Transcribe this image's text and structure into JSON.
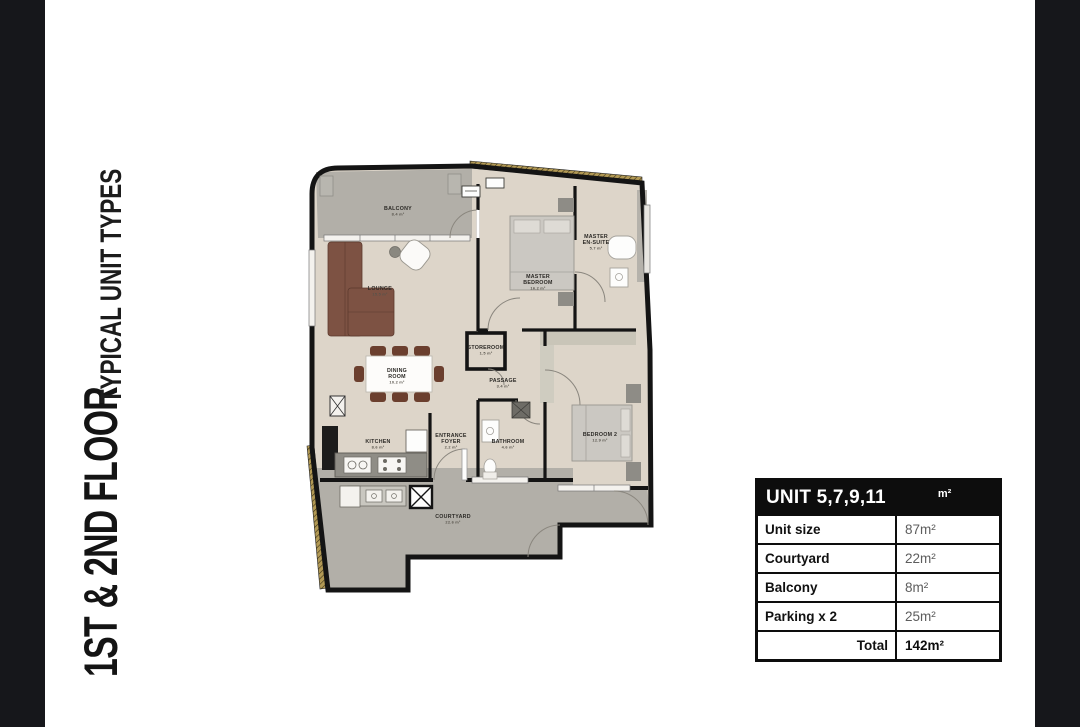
{
  "page": {
    "main_title": "1ST & 2ND FLOOR",
    "sub_title": "TYPICAL UNIT TYPES"
  },
  "unit_table": {
    "header": {
      "unit_name": "UNIT 5,7,9,11",
      "unit_sup": "m²"
    },
    "rows": [
      {
        "label": "Unit size",
        "value": "87m²"
      },
      {
        "label": "Courtyard",
        "value": "22m²"
      },
      {
        "label": "Balcony",
        "value": "8m²"
      },
      {
        "label": "Parking x 2",
        "value": "25m²"
      }
    ],
    "total": {
      "label": "Total",
      "value": "142m²"
    }
  },
  "floor_plan": {
    "rooms": [
      {
        "id": "balcony",
        "lines": [
          "BALCONY"
        ],
        "area": "8.4 m²",
        "x": 108,
        "y": 60
      },
      {
        "id": "lounge",
        "lines": [
          "LOUNGE"
        ],
        "area": "15.5 m²",
        "x": 90,
        "y": 140
      },
      {
        "id": "master-bedroom",
        "lines": [
          "MASTER",
          "BEDROOM"
        ],
        "area": "16.2 m²",
        "x": 248,
        "y": 128
      },
      {
        "id": "master-ensuite",
        "lines": [
          "MASTER",
          "EN-SUITE"
        ],
        "area": "5.7 m²",
        "x": 306,
        "y": 88
      },
      {
        "id": "storeroom",
        "lines": [
          "STOREROOM"
        ],
        "area": "1.5 m²",
        "x": 196,
        "y": 199
      },
      {
        "id": "passage",
        "lines": [
          "PASSAGE"
        ],
        "area": "3.4 m²",
        "x": 213,
        "y": 232
      },
      {
        "id": "dining-room",
        "lines": [
          "DINING",
          "ROOM"
        ],
        "area": "10.2 m²",
        "x": 107,
        "y": 222
      },
      {
        "id": "kitchen",
        "lines": [
          "KITCHEN"
        ],
        "area": "8.6 m²",
        "x": 88,
        "y": 293
      },
      {
        "id": "entrance-foyer",
        "lines": [
          "ENTRANCE",
          "FOYER"
        ],
        "area": "2.2 m²",
        "x": 161,
        "y": 287
      },
      {
        "id": "bathroom",
        "lines": [
          "BATHROOM"
        ],
        "area": "4.6 m²",
        "x": 218,
        "y": 293
      },
      {
        "id": "bedroom-2",
        "lines": [
          "BEDROOM 2"
        ],
        "area": "12.9 m²",
        "x": 310,
        "y": 286
      },
      {
        "id": "courtyard",
        "lines": [
          "COURTYARD"
        ],
        "area": "22.6 m²",
        "x": 163,
        "y": 368
      }
    ],
    "colors": {
      "wall": "#141414",
      "floor_indoor": "#ddd5c9",
      "floor_outdoor": "#b2afa8",
      "boundary_gold": "#b39a55",
      "sofa": "#7d5243",
      "chair": "#6b3f2e"
    }
  }
}
